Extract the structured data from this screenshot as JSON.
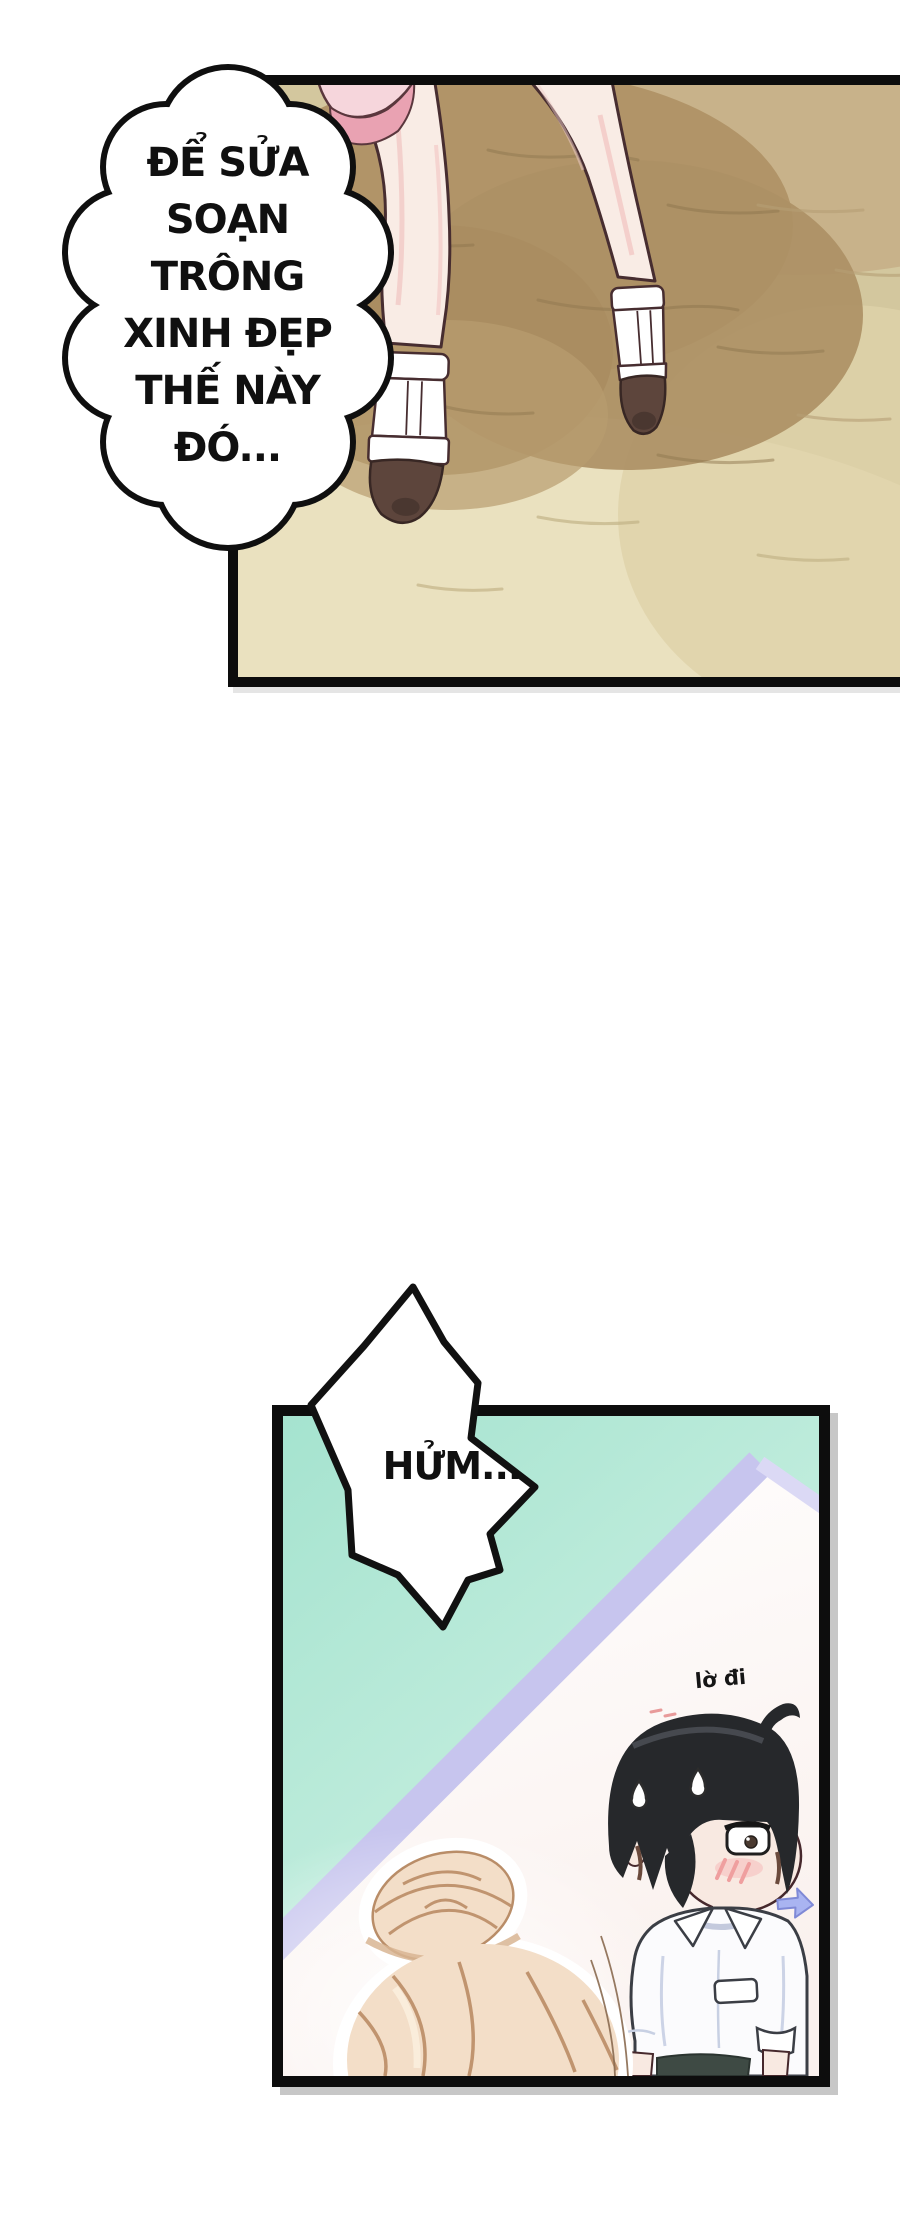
{
  "page": {
    "width_px": 900,
    "height_px": 2228,
    "background": "#ffffff",
    "media_type": "manga / webtoon page"
  },
  "panel_top": {
    "thought_bubble": {
      "lines": [
        "ĐỂ SỬA",
        "SOẠN",
        "TRÔNG",
        "XINH ĐẸP",
        "THẾ NÀY",
        "ĐÓ..."
      ]
    },
    "scene": "bare legs in white T-strap platform shoes stepping on sand, pink skirt hem at top",
    "colors": {
      "border": "#0d0d0d",
      "sand_base": "#d3c79e",
      "sand_shadow": "#ad9065",
      "sand_light": "#eae1bf",
      "sand_top_right": "#c8b28a",
      "skin": "#f9ece5",
      "skin_shade": "#f1c5c2",
      "outline": "#472d30",
      "skirt_light_pink": "#f6d6dc",
      "skirt_dark_pink": "#e9a2b2",
      "shoe_white": "#ffffff",
      "shoe_toe_brown": "#5d453c"
    }
  },
  "panel_bottom": {
    "burst_bubble": {
      "text": "HỬM..."
    },
    "whisper_label": {
      "text": "lờ đi"
    },
    "scene": "chibi black-haired boy in white shirt sweating and glancing aside (arrow), blonde hair-bun girl in foreground, lavender mirror edge diagonal over mint background",
    "colors": {
      "border": "#0d0d0d",
      "mint": "#a5e3cf",
      "mint_light": "#ddf6ec",
      "mirror_stripe": "#c7c5ee",
      "floor_white": "#fdfbfa",
      "boy_hair": "#26282b",
      "blonde_hair": "#f3dec8",
      "blonde_hair_line": "#c0946f",
      "shirt_white": "#fbfbfd",
      "shirt_shade": "#c8d0e3",
      "waistband": "#3e4a44",
      "skin": "#f8e9e1",
      "blush": "#ef9f9f",
      "arrow": "#a9b4f1"
    }
  }
}
